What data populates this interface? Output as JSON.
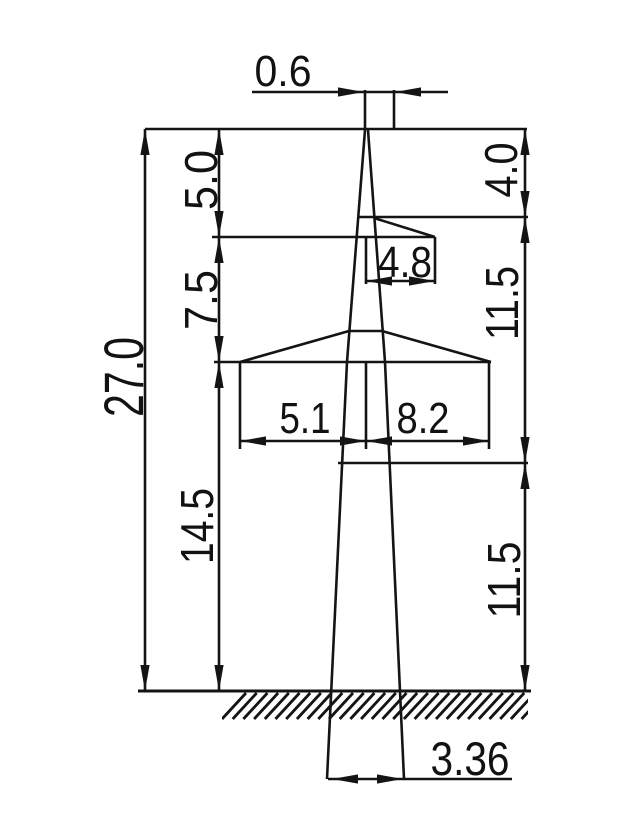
{
  "drawing_title": "transmission-tower-elevation-with-dimensions",
  "canvas": {
    "width": 640,
    "height": 840,
    "background": "#ffffff",
    "line_color": "#141414",
    "line_width": 2.6
  },
  "dimension_values": {
    "top_width": "0.6",
    "total_height": "27.0",
    "upper_left_height": "5.0",
    "middle_left_height": "7.5",
    "lower_left_height": "14.5",
    "upper_right_height": "4.0",
    "middle_right_height": "11.5",
    "lower_right_height": "11.5",
    "upper_arm_reach": "4.8",
    "crossarm_left_reach": "5.1",
    "crossarm_right_reach": "8.2",
    "base_width": "3.36"
  },
  "drawing": {
    "segments": [
      {
        "name": "dim-0.6-ext-left",
        "x1": 365,
        "y1": 90,
        "x2": 365,
        "y2": 129
      },
      {
        "name": "dim-0.6-ext-right",
        "x1": 394,
        "y1": 90,
        "x2": 394,
        "y2": 129
      },
      {
        "name": "dim-0.6-line-mid",
        "x1": 365,
        "y1": 92,
        "x2": 394,
        "y2": 92
      },
      {
        "name": "dim-0.6-line-left",
        "x1": 252,
        "y1": 92,
        "x2": 364,
        "y2": 92
      },
      {
        "name": "dim-0.6-line-right",
        "x1": 395,
        "y1": 92,
        "x2": 448,
        "y2": 92
      },
      {
        "name": "tower-top-line",
        "x1": 145,
        "y1": 129,
        "x2": 527,
        "y2": 129
      },
      {
        "name": "upper-arm-top-line",
        "x1": 357,
        "y1": 217,
        "x2": 528,
        "y2": 217
      },
      {
        "name": "upper-arm-slant",
        "x1": 374,
        "y1": 218,
        "x2": 435,
        "y2": 237
      },
      {
        "name": "upper-arm-tip-ext",
        "x1": 435,
        "y1": 237,
        "x2": 435,
        "y2": 284
      },
      {
        "name": "upper-arm-bottom-line",
        "x1": 212,
        "y1": 237,
        "x2": 435,
        "y2": 237
      },
      {
        "name": "dim-4.8-ext-center",
        "x1": 366,
        "y1": 238,
        "x2": 366,
        "y2": 284
      },
      {
        "name": "dim-4.8-line",
        "x1": 366,
        "y1": 281,
        "x2": 435,
        "y2": 281
      },
      {
        "name": "crossarm-bottom-line",
        "x1": 214,
        "y1": 362,
        "x2": 491,
        "y2": 362
      },
      {
        "name": "crossarm-roof-left",
        "x1": 240,
        "y1": 362,
        "x2": 349,
        "y2": 331
      },
      {
        "name": "crossarm-roof-top",
        "x1": 349,
        "y1": 331,
        "x2": 382,
        "y2": 331
      },
      {
        "name": "crossarm-roof-right",
        "x1": 382,
        "y1": 331,
        "x2": 491,
        "y2": 362
      },
      {
        "name": "dim-5.1-ext-left",
        "x1": 240,
        "y1": 362,
        "x2": 240,
        "y2": 449
      },
      {
        "name": "dim-center-ext",
        "x1": 366,
        "y1": 362,
        "x2": 366,
        "y2": 449
      },
      {
        "name": "dim-8.2-ext-right",
        "x1": 489,
        "y1": 362,
        "x2": 489,
        "y2": 449
      },
      {
        "name": "dim-5.1-line",
        "x1": 240,
        "y1": 441,
        "x2": 366,
        "y2": 441
      },
      {
        "name": "dim-8.2-line",
        "x1": 366,
        "y1": 441,
        "x2": 489,
        "y2": 441
      },
      {
        "name": "mid-right-level-line",
        "x1": 338,
        "y1": 463,
        "x2": 528,
        "y2": 463
      },
      {
        "name": "ground-line",
        "x1": 138,
        "y1": 691,
        "x2": 531,
        "y2": 691,
        "w": 3
      },
      {
        "name": "dim-3.36-line",
        "x1": 328,
        "y1": 779,
        "x2": 512,
        "y2": 779
      },
      {
        "name": "dim-27.0-line",
        "x1": 145,
        "y1": 129,
        "x2": 145,
        "y2": 691
      },
      {
        "name": "dim-left-stack-line",
        "x1": 219,
        "y1": 129,
        "x2": 219,
        "y2": 691
      },
      {
        "name": "dim-right-stack-line",
        "x1": 525,
        "y1": 129,
        "x2": 525,
        "y2": 691
      }
    ],
    "polylines": [
      {
        "name": "mast-left-edge",
        "pts": [
          [
            365,
            130
          ],
          [
            347,
            362
          ],
          [
            327,
            779
          ]
        ]
      },
      {
        "name": "mast-right-edge",
        "pts": [
          [
            368,
            130
          ],
          [
            385,
            362
          ],
          [
            404,
            779
          ]
        ]
      }
    ],
    "arrows": [
      {
        "name": "arrow-0.6-left",
        "x": 364,
        "y": 92,
        "dir": "right"
      },
      {
        "name": "arrow-0.6-right",
        "x": 395,
        "y": 92,
        "dir": "left"
      },
      {
        "name": "arrow-27.0-top",
        "x": 145,
        "y": 129,
        "dir": "up"
      },
      {
        "name": "arrow-27.0-bottom",
        "x": 145,
        "y": 691,
        "dir": "down"
      },
      {
        "name": "arrow-5.0-top",
        "x": 219,
        "y": 129,
        "dir": "up"
      },
      {
        "name": "arrow-5.0-bottom",
        "x": 219,
        "y": 237,
        "dir": "down"
      },
      {
        "name": "arrow-7.5-top",
        "x": 219,
        "y": 237,
        "dir": "up"
      },
      {
        "name": "arrow-7.5-bottom",
        "x": 219,
        "y": 362,
        "dir": "down"
      },
      {
        "name": "arrow-14.5-top",
        "x": 219,
        "y": 362,
        "dir": "up"
      },
      {
        "name": "arrow-14.5-bottom",
        "x": 219,
        "y": 691,
        "dir": "down"
      },
      {
        "name": "arrow-4.0-top",
        "x": 525,
        "y": 129,
        "dir": "up"
      },
      {
        "name": "arrow-4.0-bottom",
        "x": 525,
        "y": 217,
        "dir": "down"
      },
      {
        "name": "arrow-11.5u-top",
        "x": 525,
        "y": 217,
        "dir": "up"
      },
      {
        "name": "arrow-11.5u-bottom",
        "x": 525,
        "y": 463,
        "dir": "down"
      },
      {
        "name": "arrow-11.5l-top",
        "x": 525,
        "y": 463,
        "dir": "up"
      },
      {
        "name": "arrow-11.5l-bottom",
        "x": 525,
        "y": 691,
        "dir": "down"
      },
      {
        "name": "arrow-4.8-left",
        "x": 366,
        "y": 281,
        "dir": "left"
      },
      {
        "name": "arrow-4.8-right",
        "x": 435,
        "y": 281,
        "dir": "right"
      },
      {
        "name": "arrow-5.1-left",
        "x": 240,
        "y": 441,
        "dir": "left"
      },
      {
        "name": "arrow-5.1-right",
        "x": 366,
        "y": 441,
        "dir": "right"
      },
      {
        "name": "arrow-8.2-left",
        "x": 366,
        "y": 441,
        "dir": "left"
      },
      {
        "name": "arrow-8.2-right",
        "x": 489,
        "y": 441,
        "dir": "right"
      },
      {
        "name": "arrow-3.36-left",
        "x": 332,
        "y": 779,
        "dir": "left"
      },
      {
        "name": "arrow-3.36-right",
        "x": 403,
        "y": 779,
        "dir": "right"
      }
    ],
    "labels": [
      {
        "name": "dim-label-top-width",
        "text": "0.6",
        "x": 283,
        "y": 86,
        "rot": false,
        "size": 44,
        "len": 57
      },
      {
        "name": "dim-label-total-height",
        "text": "27.0",
        "x": 143,
        "y": 377,
        "rot": true,
        "size": 56,
        "len": 80
      },
      {
        "name": "dim-label-upper-left",
        "text": "5.0",
        "x": 217,
        "y": 180,
        "rot": true,
        "size": 46,
        "len": 60
      },
      {
        "name": "dim-label-middle-left",
        "text": "7.5",
        "x": 217,
        "y": 300,
        "rot": true,
        "size": 46,
        "len": 60
      },
      {
        "name": "dim-label-lower-left",
        "text": "14.5",
        "x": 213,
        "y": 526,
        "rot": true,
        "size": 46,
        "len": 76
      },
      {
        "name": "dim-label-upper-right",
        "text": "4.0",
        "x": 517,
        "y": 170,
        "rot": true,
        "size": 46,
        "len": 55
      },
      {
        "name": "dim-label-middle-right",
        "text": "11.5",
        "x": 518,
        "y": 303,
        "rot": true,
        "size": 46,
        "len": 74
      },
      {
        "name": "dim-label-lower-right",
        "text": "11.5",
        "x": 520,
        "y": 580,
        "rot": true,
        "size": 46,
        "len": 77
      },
      {
        "name": "dim-label-arm-reach",
        "text": "4.8",
        "x": 405,
        "y": 277,
        "rot": false,
        "size": 44,
        "len": 54
      },
      {
        "name": "dim-label-crossarm-left",
        "text": "5.1",
        "x": 305,
        "y": 433,
        "rot": false,
        "size": 44,
        "len": 51
      },
      {
        "name": "dim-label-crossarm-right",
        "text": "8.2",
        "x": 423,
        "y": 433,
        "rot": false,
        "size": 44,
        "len": 53
      },
      {
        "name": "dim-label-base-width",
        "text": "3.36",
        "x": 470,
        "y": 775,
        "rot": false,
        "size": 47,
        "len": 79
      }
    ],
    "hatch": {
      "name": "ground-hatch",
      "x0": 222,
      "x1": 528,
      "y_top": 693,
      "y_bottom": 719,
      "step": 10.7,
      "dx": 24,
      "stroke_width": 2.8
    }
  }
}
